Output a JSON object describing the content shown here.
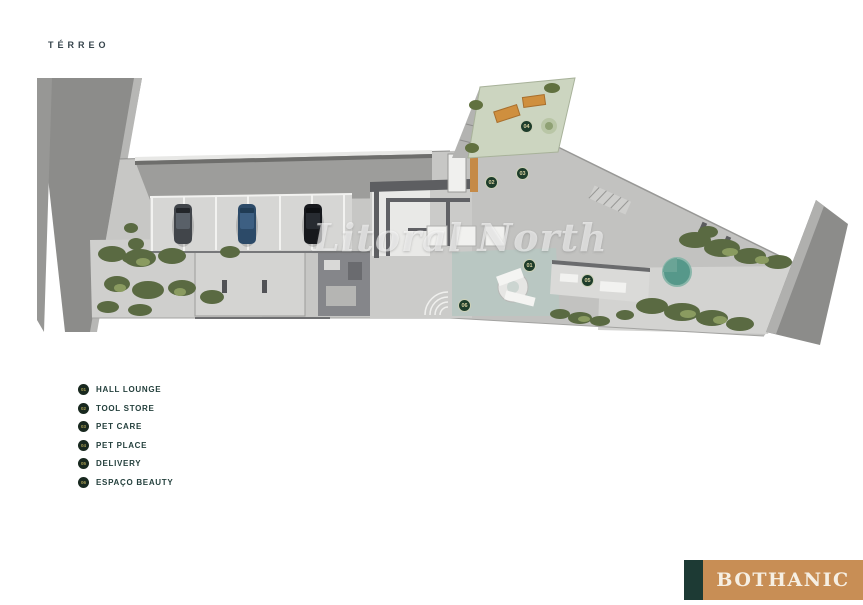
{
  "page": {
    "title": "TÉRREO"
  },
  "watermark": {
    "text": "Litoral North"
  },
  "plan": {
    "floor_name": "TÉRREO",
    "badge_numbers": [
      "01",
      "02",
      "03",
      "04",
      "05",
      "06"
    ]
  },
  "legend": {
    "items": [
      {
        "number": "01",
        "label": "HALL LOUNGE"
      },
      {
        "number": "02",
        "label": "TOOL STORE"
      },
      {
        "number": "03",
        "label": "PET CARE"
      },
      {
        "number": "04",
        "label": "PET PLACE"
      },
      {
        "number": "05",
        "label": "DELIVERY"
      },
      {
        "number": "06",
        "label": "ESPAÇO BEAUTY"
      }
    ]
  },
  "brand": {
    "name": "BOTHANIC"
  },
  "colors": {
    "brand_orange": "#c88e55",
    "brand_green": "#1d3a34",
    "badge_green": "#1e3d2b",
    "pet_area_green": "#ccd5c0",
    "legend_text": "#24403d",
    "road_gray": "#8c8c8a",
    "slab_gray": "#c7c7c5"
  }
}
